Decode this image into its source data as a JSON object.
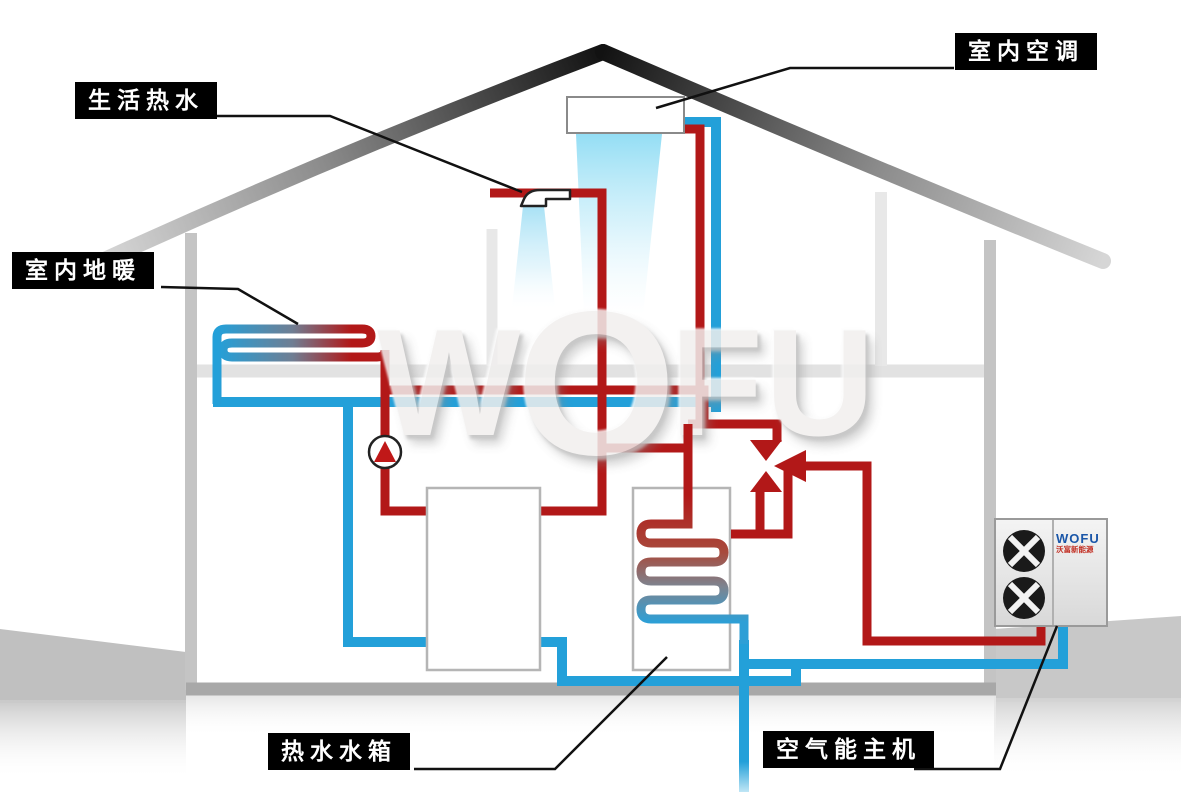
{
  "diagram_title": "air-source heat pump whole-house system diagram",
  "colors": {
    "pipe_hot": "#b21818",
    "pipe_cold": "#23a0d9",
    "label_bg": "#000000",
    "label_text": "#ffffff",
    "structure_gray": "#c4c4c4",
    "logo_blue": "#1a56a8",
    "logo_red": "#c23024"
  },
  "labels": {
    "domestic_hot_water": "生活热水",
    "indoor_ac": "室内空调",
    "floor_heating": "室内地暖",
    "hot_water_tank": "热水水箱",
    "heat_pump_unit": "空气能主机"
  },
  "watermark": {
    "letters": [
      "W",
      "O",
      "F",
      "U"
    ]
  },
  "outdoor_unit": {
    "brand": "WOFU",
    "brand_sub": "沃富新能源"
  },
  "icons": [
    "shower-icon",
    "pump-icon",
    "three-way-valve-icon",
    "fan-icon",
    "ac-indoor-unit",
    "buffer-tank",
    "hot-water-tank",
    "heat-exchanger-coil",
    "floor-heating-coil"
  ]
}
